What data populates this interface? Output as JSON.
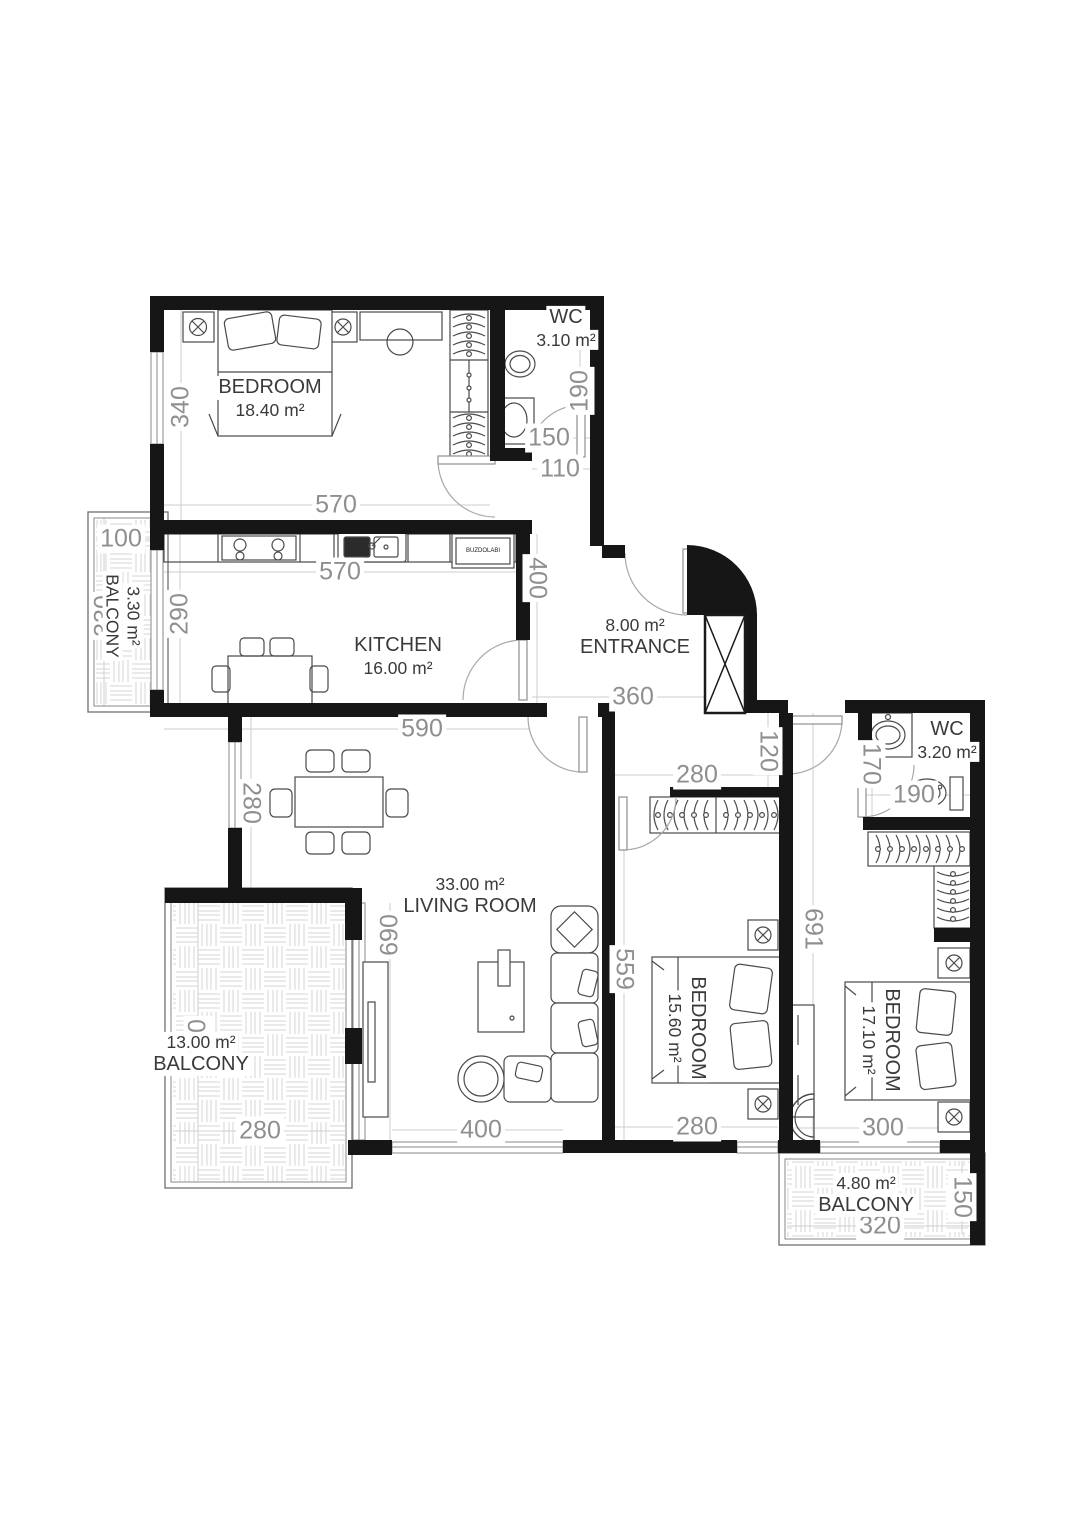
{
  "plan": {
    "type": "apartment-floor-plan",
    "colors": {
      "wall": "#161616",
      "dim_text": "#8f8f8f",
      "room_text": "#3a3a3a",
      "furniture_line": "#4a4a4a",
      "hatch_line": "#d4d4d4",
      "door_arc": "#a8a8a8"
    },
    "rooms": [
      {
        "name": "BEDROOM",
        "area": "18.40 m²"
      },
      {
        "name": "WC",
        "area": "3.10 m²"
      },
      {
        "name": "KITCHEN",
        "area": "16.00 m²"
      },
      {
        "name": "ENTRANCE",
        "area": "8.00 m²"
      },
      {
        "name": "BALCONY",
        "area": "3.30 m²"
      },
      {
        "name": "LIVING ROOM",
        "area": "33.00 m²"
      },
      {
        "name": "BALCONY",
        "area": "13.00 m²"
      },
      {
        "name": "BEDROOM",
        "area": "15.60 m²"
      },
      {
        "name": "BEDROOM",
        "area": "17.10 m²"
      },
      {
        "name": "WC",
        "area": "3.20 m²"
      },
      {
        "name": "BALCONY",
        "area": "4.80 m²"
      }
    ],
    "appliances": {
      "fridge": "BUZDOLABI"
    },
    "dims": [
      "340",
      "570",
      "190",
      "150",
      "110",
      "100",
      "330",
      "290",
      "570",
      "400",
      "590",
      "360",
      "120",
      "280",
      "170",
      "190",
      "691",
      "559",
      "690",
      "280",
      "480",
      "280",
      "400",
      "280",
      "300",
      "150",
      "320"
    ]
  }
}
